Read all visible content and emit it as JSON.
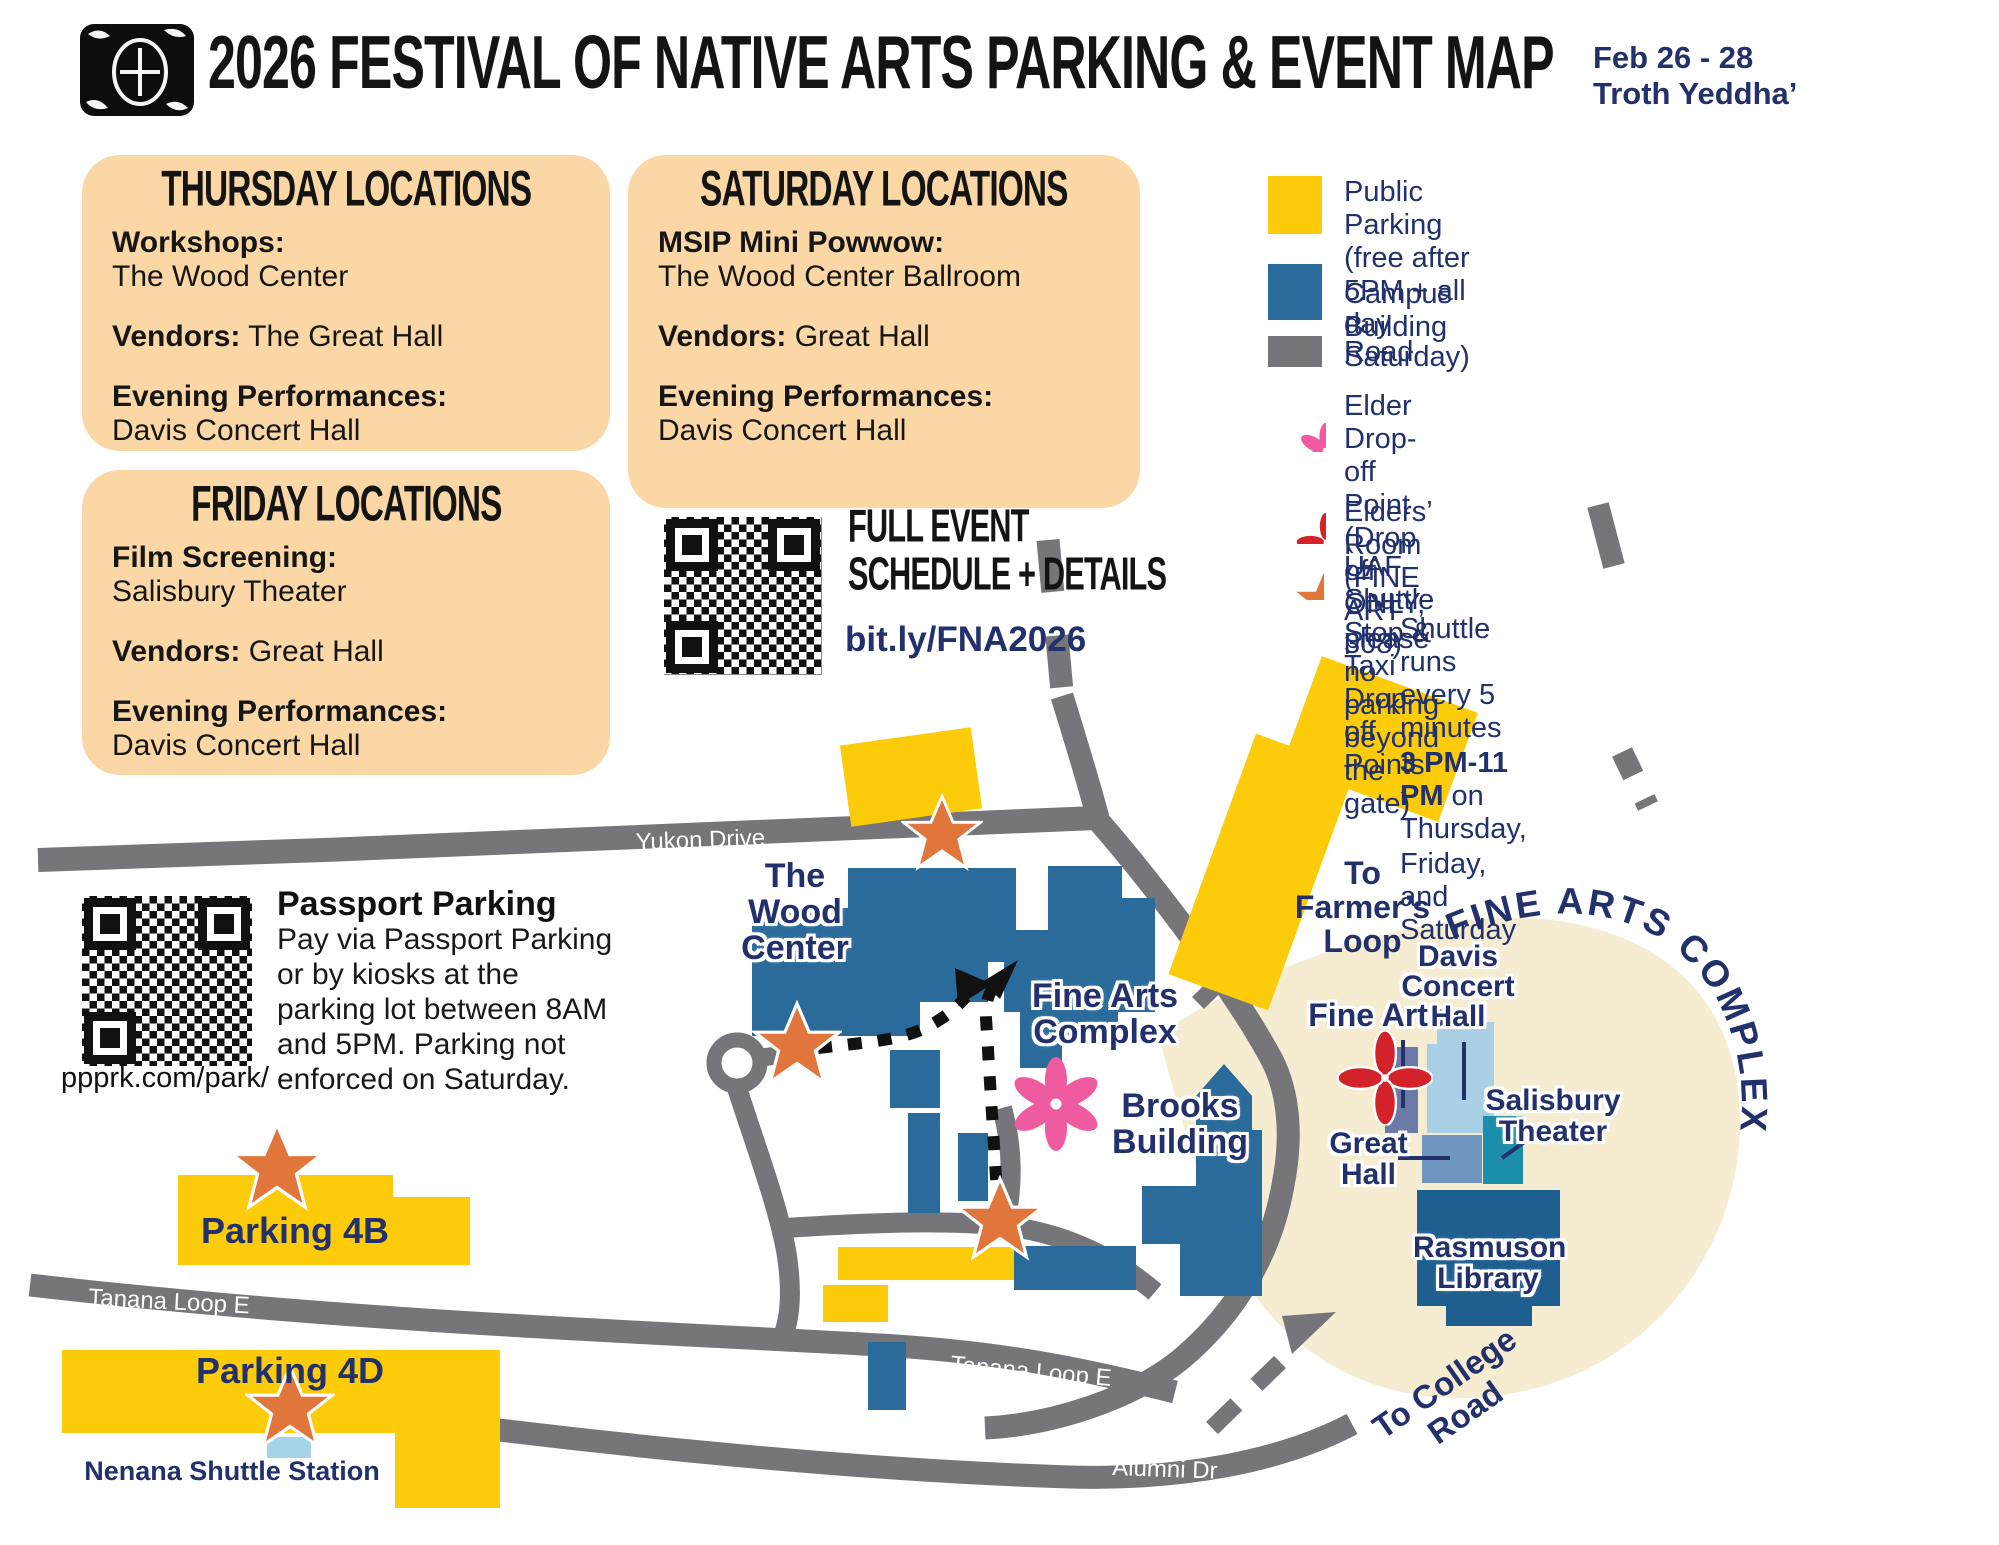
{
  "header": {
    "title": "2026 FESTIVAL OF NATIVE ARTS PARKING & EVENT MAP",
    "date_line1": "Feb 26 - 28",
    "date_line2": "Troth Yeddha’"
  },
  "day_boxes": {
    "thursday": {
      "title": "THURSDAY LOCATIONS",
      "items": [
        {
          "label": "Workshops:",
          "value": "The Wood Center"
        },
        {
          "label": "Vendors:",
          "value": "The Great Hall"
        },
        {
          "label": "Evening Performances:",
          "value": "Davis Concert Hall"
        }
      ]
    },
    "friday": {
      "title": "FRIDAY LOCATIONS",
      "items": [
        {
          "label": "Film Screening:",
          "value": "Salisbury Theater"
        },
        {
          "label": "Vendors:",
          "value": "Great Hall"
        },
        {
          "label": "Evening Performances:",
          "value": "Davis Concert Hall"
        }
      ]
    },
    "saturday": {
      "title": "SATURDAY LOCATIONS",
      "items": [
        {
          "label": "MSIP Mini Powwow:",
          "value": "The Wood Center Ballroom"
        },
        {
          "label": "Vendors:",
          "value": "Great Hall"
        },
        {
          "label": "Evening Performances:",
          "value": "Davis Concert Hall"
        }
      ]
    }
  },
  "schedule_qr": {
    "heading_line1": "FULL EVENT",
    "heading_line2": "SCHEDULE + DETAILS",
    "link": "bit.ly/FNA2026"
  },
  "legend": {
    "public_parking_line1": "Public Parking",
    "public_parking_line2": "(free after 5PM + all day Saturday)",
    "campus_building": "Campus Building",
    "road": "Road",
    "elder_dropoff_line1": "Elder Drop-off Point (Drop off ONLY,",
    "elder_dropoff_line2": "please no parking beyond the gate)",
    "elders_room": "Elders’ Room (FINE ART 308)",
    "shuttle_stop": "UAF Shuttle Stop & Taxi Drop off Points",
    "shuttle_note_line1": "Shuttle runs every 5 minutes",
    "shuttle_note_bold": "3 PM-11 PM",
    "shuttle_note_line2_rest": " on Thursday,",
    "shuttle_note_line3": "Friday, and Saturday"
  },
  "passport": {
    "qr_caption": "ppprk.com/park/",
    "title": "Passport Parking",
    "body": "Pay via Passport Parking or by kiosks at the parking lot between 8AM and 5PM. Parking not enforced on Saturday."
  },
  "map": {
    "roads": {
      "yukon": "Yukon Drive",
      "tanana_left": "Tanana Loop E",
      "tanana_center": "Tanana Loop E",
      "alumni": "Alumni Dr"
    },
    "labels": {
      "wood_center": "The\nWood\nCenter",
      "fine_arts_complex": "Fine Arts\nComplex",
      "brooks": "Brooks\nBuilding",
      "to_farmers_loop": "To Farmer’s\nLoop",
      "to_college_road": "To College\nRoad",
      "parking_4b": "Parking 4B",
      "parking_4d": "Parking 4D",
      "nenana": "Nenana Shuttle Station"
    },
    "inset": {
      "arc_title": "FINE ARTS COMPLEX",
      "fine_arts": "Fine Arts",
      "davis": "Davis\nConcert\nHall",
      "salisbury": "Salisbury\nTheater",
      "great_hall": "Great\nHall",
      "rasmuson": "Rasmuson\nLibrary"
    }
  },
  "colors": {
    "peach": "#fad7a5",
    "parking_yellow": "#fccb0a",
    "campus_blue": "#2a6b9b",
    "road_gray": "#76757a",
    "navy": "#22316b",
    "elder_pink": "#ef5ba1",
    "elders_room_red": "#d3222a",
    "shuttle_orange": "#e0763c",
    "inset_beige": "#f6ecd2"
  }
}
